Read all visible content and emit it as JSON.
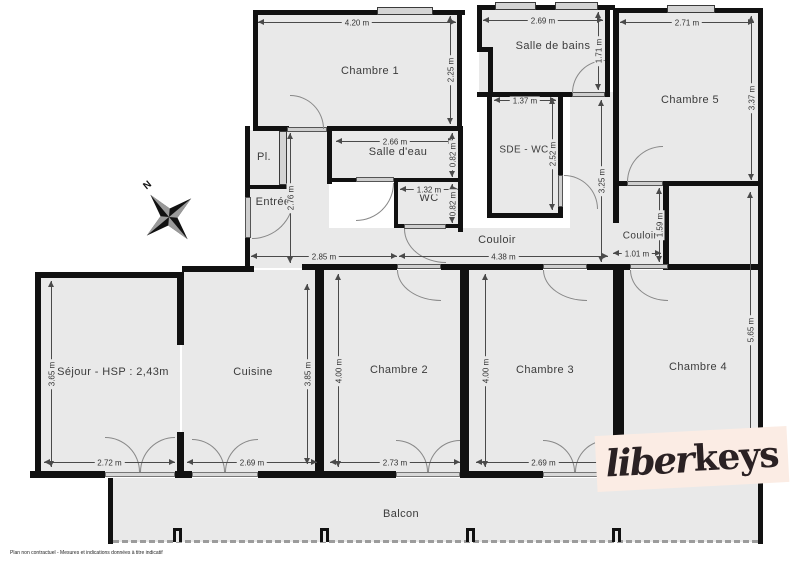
{
  "plan": {
    "rooms": {
      "chambre1": "Chambre 1",
      "salle_de_bains": "Salle de bains",
      "chambre5": "Chambre 5",
      "pl": "Pl.",
      "salle_deau": "Salle d'eau",
      "sde_wc": "SDE - WC",
      "wc": "WC",
      "entree": "Entrée",
      "couloir": "Couloir",
      "couloir2": "Couloir",
      "sejour": "Séjour - HSP : 2,43m",
      "cuisine": "Cuisine",
      "chambre2": "Chambre 2",
      "chambre3": "Chambre 3",
      "chambre4": "Chambre 4",
      "balcon": "Balcon"
    },
    "dims": {
      "chambre1_width": "4.20 m",
      "chambre1_height": "2.25 m",
      "salle_de_bains_width": "2.69 m",
      "salle_de_bains_height": "1.71 m",
      "chambre5_width": "2.71 m",
      "chambre5_height": "3.37 m",
      "salle_deau_width": "2.66 m",
      "salle_deau_height": "0.82 m",
      "sde_wc_width": "1.37 m",
      "sde_wc_height": "2.52 m",
      "wc_width": "1.32 m",
      "wc_height": "0.82 m",
      "entree_height": "2.76 m",
      "passage_height": "3.25 m",
      "couloir2_height": "1.59 m",
      "couloir2_width": "1.01 m",
      "couloir_left": "2.85 m",
      "couloir_right": "4.38 m",
      "sejour_height": "3.65 m",
      "sejour_width": "2.72 m",
      "cuisine_width": "2.69 m",
      "cuisine_height": "3.85 m",
      "chambre2_height": "4.00 m",
      "chambre2_width": "2.73 m",
      "chambre3_height": "4.00 m",
      "chambre3_width": "2.69 m",
      "chambre4_height": "5.65 m"
    },
    "compass_n": "N",
    "logo": {
      "script": "liber",
      "bold": "keys"
    },
    "disclaimer": "Plan non contractuel - Mesures et indications données à titre indicatif",
    "colors": {
      "room_fill": "#e9e9e9",
      "wall": "#111111",
      "logo_bg": "#fbece4",
      "logo_text": "#2a2123"
    }
  }
}
